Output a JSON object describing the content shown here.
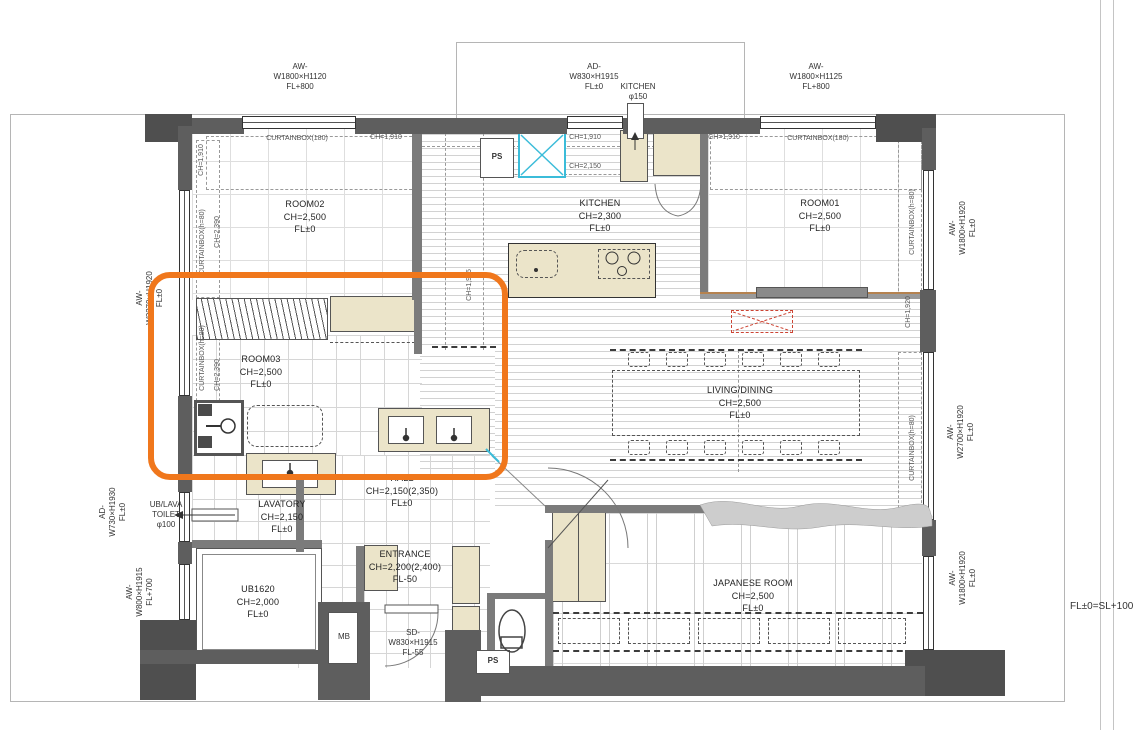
{
  "colors": {
    "highlight": "#f0771c",
    "fridge_mark": "#3bbcd9",
    "ac_mark": "#cc4433",
    "fixture": "#ebe4c9",
    "wall": "#5e5e5e"
  },
  "rooms": {
    "room02": "ROOM02\nCH=2,500\nFL±0",
    "kitchen": "KITCHEN\nCH=2,300\nFL±0",
    "room01": "ROOM01\nCH=2,500\nFL±0",
    "room03": "ROOM03\nCH=2,500\nFL±0",
    "living_dining": "LIVING/DINING\nCH=2,500\nFL±0",
    "lavatory": "LAVATORY\nCH=2,150\nFL±0",
    "hall": "HALL\nCH=2,150(2,350)\nFL±0",
    "entrance": "ENTRANCE\nCH=2,200(2,400)\nFL-50",
    "ub": "UB1620\nCH=2,000\nFL±0",
    "japanese": "JAPANESE ROOM\nCH=2,500\nFL±0"
  },
  "openings": {
    "aw_top_left": "AW-\nW1800×H1120\nFL+800",
    "ad_top": "AD-\nW830×H1915\nFL±0",
    "kitchen_duct": "KITCHEN\nφ150",
    "aw_top_right": "AW-\nW1800×H1125\nFL+800",
    "aw_left": "AW-\nW3270×H1920\nFL±0",
    "ad_left": "AD-\nW730×H1930\nFL±0",
    "ub_lava_toilet": "UB/LAVA\nTOILET\nφ100",
    "aw_left_low": "AW-\nW800×H1915\nFL+700",
    "aw_right_1800": "AW-\nW1800×H1920\nFL±0",
    "aw_right_2700": "AW-\nW2700×H1920\nFL±0",
    "sd_entrance": "SD-\nW830×H1915\nFL-55"
  },
  "ceiling": {
    "curtainbox_top": "CURTAINBOX(180)",
    "curtainbox_side": "CURTAINBOX(h=80)",
    "ch1910": "CH=1,910",
    "ch2150": "CH=2,150",
    "ch2390": "CH=2,390",
    "ch1975": "CH=1,975",
    "ch1920": "CH=1,920"
  },
  "service": {
    "mb": "MB",
    "ps": "PS"
  },
  "note": {
    "floor_level": "FL±0=SL+100"
  }
}
